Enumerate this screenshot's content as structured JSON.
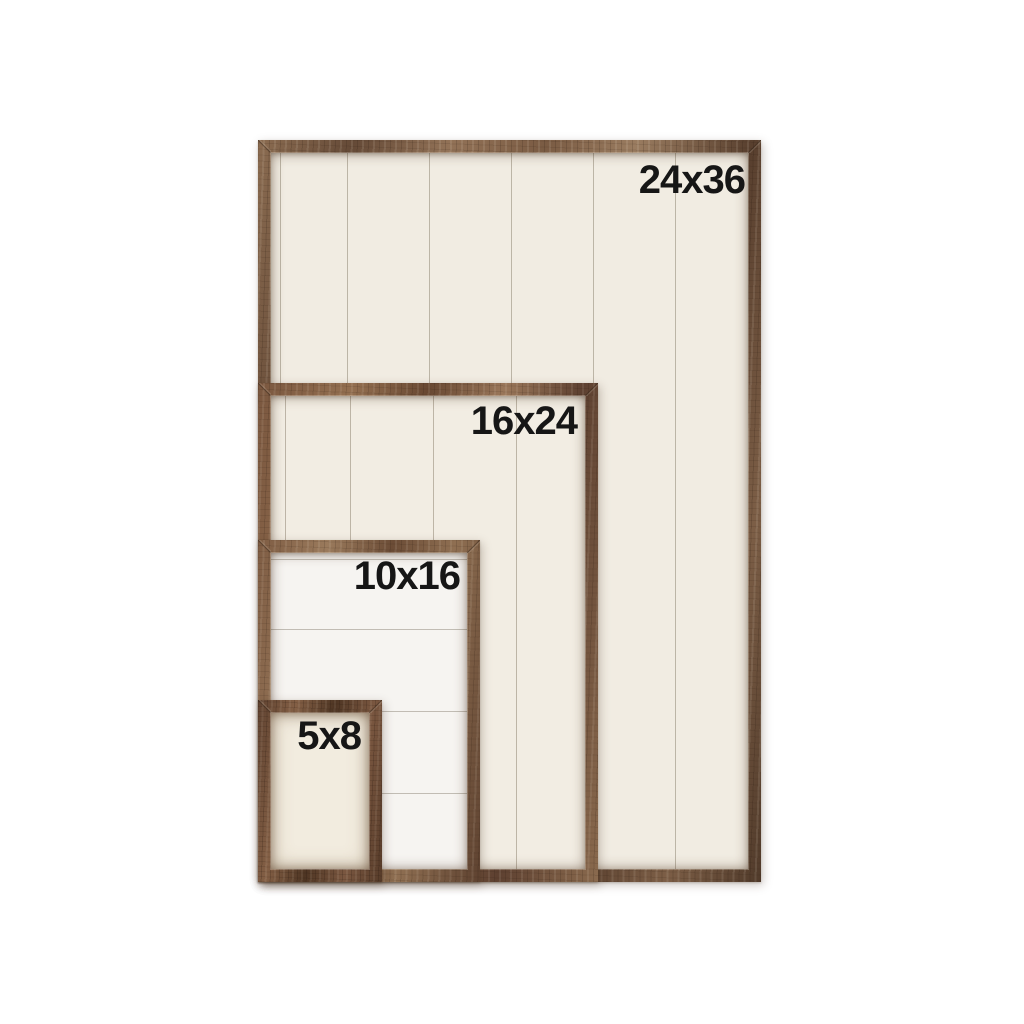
{
  "canvas": {
    "background": "#ffffff",
    "description_labels_visible": [
      "24x36",
      "16x24",
      "10x16",
      "5x8"
    ]
  },
  "frames": [
    {
      "name": "frame-24x36",
      "label": "24x36"
    },
    {
      "name": "frame-16x24",
      "label": "16x24"
    },
    {
      "name": "frame-10x16",
      "label": "10x16"
    },
    {
      "name": "frame-5x8",
      "label": "5x8"
    }
  ],
  "colors": {
    "wood_brown": "#7b5c43",
    "wood_dark": "#563d2b",
    "panel_cream": "#f1ece2",
    "panel_white": "#f6f4f1",
    "plank_line": "#d7d2c7",
    "label_text": "#161616",
    "page_background": "#ffffff"
  }
}
